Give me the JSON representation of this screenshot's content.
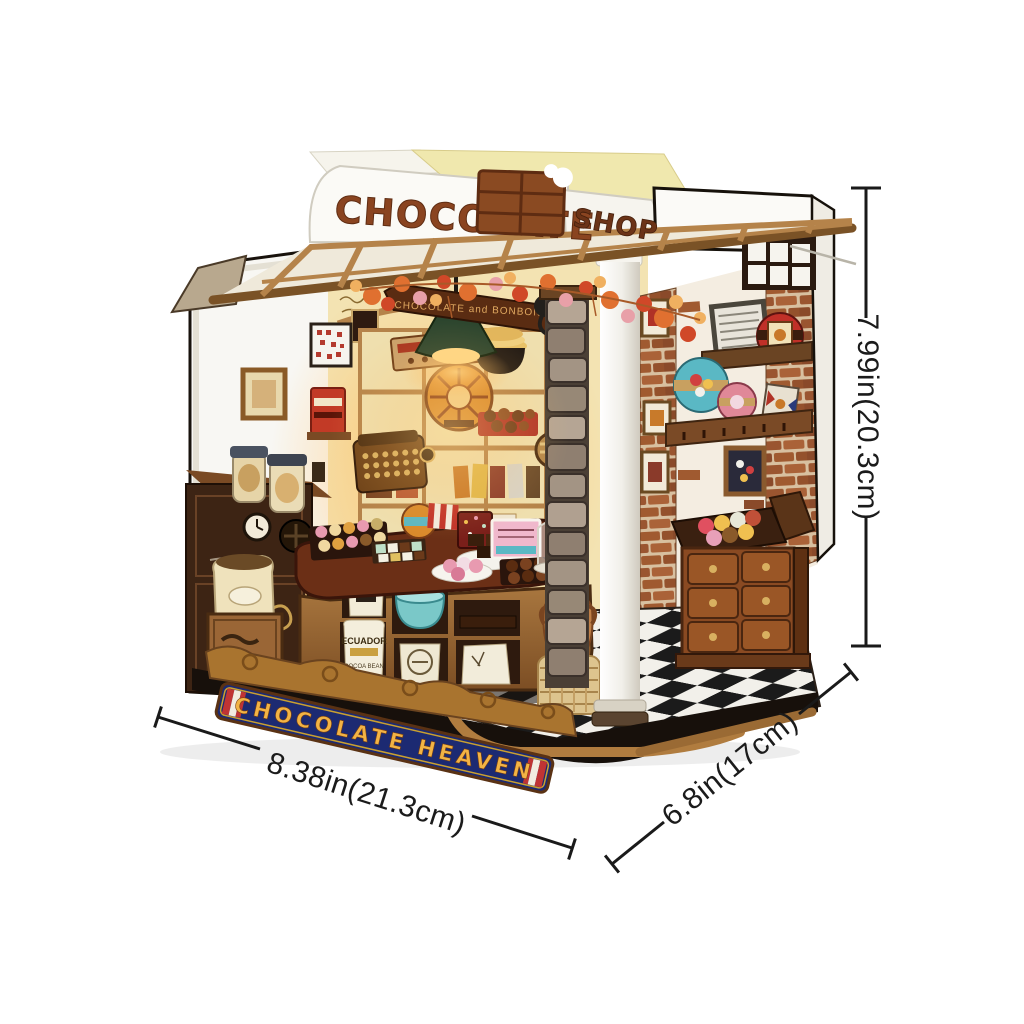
{
  "scene": {
    "description": "Product photo of a DIY miniature chocolate shop model with dimension annotations",
    "background_color": "#ffffff"
  },
  "signs": {
    "roof_main": "CHOCOLATE",
    "roof_corner": "SHOP",
    "base_banner": "CHOCOLATE HEAVEN",
    "arch_banner": "CHOCOLATE and BONBONS",
    "chalkboard": {
      "lines": [
        "FRUIT",
        "AND",
        "DRIED",
        "FRUIT",
        "FLAVORS"
      ],
      "footer": "♥"
    },
    "sack": {
      "line1": "ECUADOR",
      "line2": "COCOA BEAN"
    }
  },
  "dimensions": {
    "height": {
      "label": "7.99in(20.3cm)",
      "orientation": "vertical-right"
    },
    "width": {
      "label": "8.38in(21.3cm)",
      "orientation": "diagonal-bottom-left"
    },
    "depth": {
      "label": "6.8in(17cm)",
      "orientation": "diagonal-bottom-right"
    }
  },
  "palette": {
    "letters_brown": "#8a4420",
    "chocolate_bar": "#8a4a22",
    "banner_blue": "#1c2a72",
    "banner_gold": "#f2b345",
    "cream_wall": "#f3e3b2",
    "white_wall": "#f8f7f3",
    "brick": "#9a5530",
    "wood_light": "#c89858",
    "wood_mid": "#9a6636",
    "wood_dark": "#5a2f14",
    "lamp_green": "#2c452e",
    "accent_teal": "#5ab8c4",
    "accent_red": "#c03028",
    "accent_pink": "#e08898",
    "floor_black": "#1b1b1b",
    "floor_white": "#f2f0ea",
    "dimension_line": "#1a1a1a"
  }
}
